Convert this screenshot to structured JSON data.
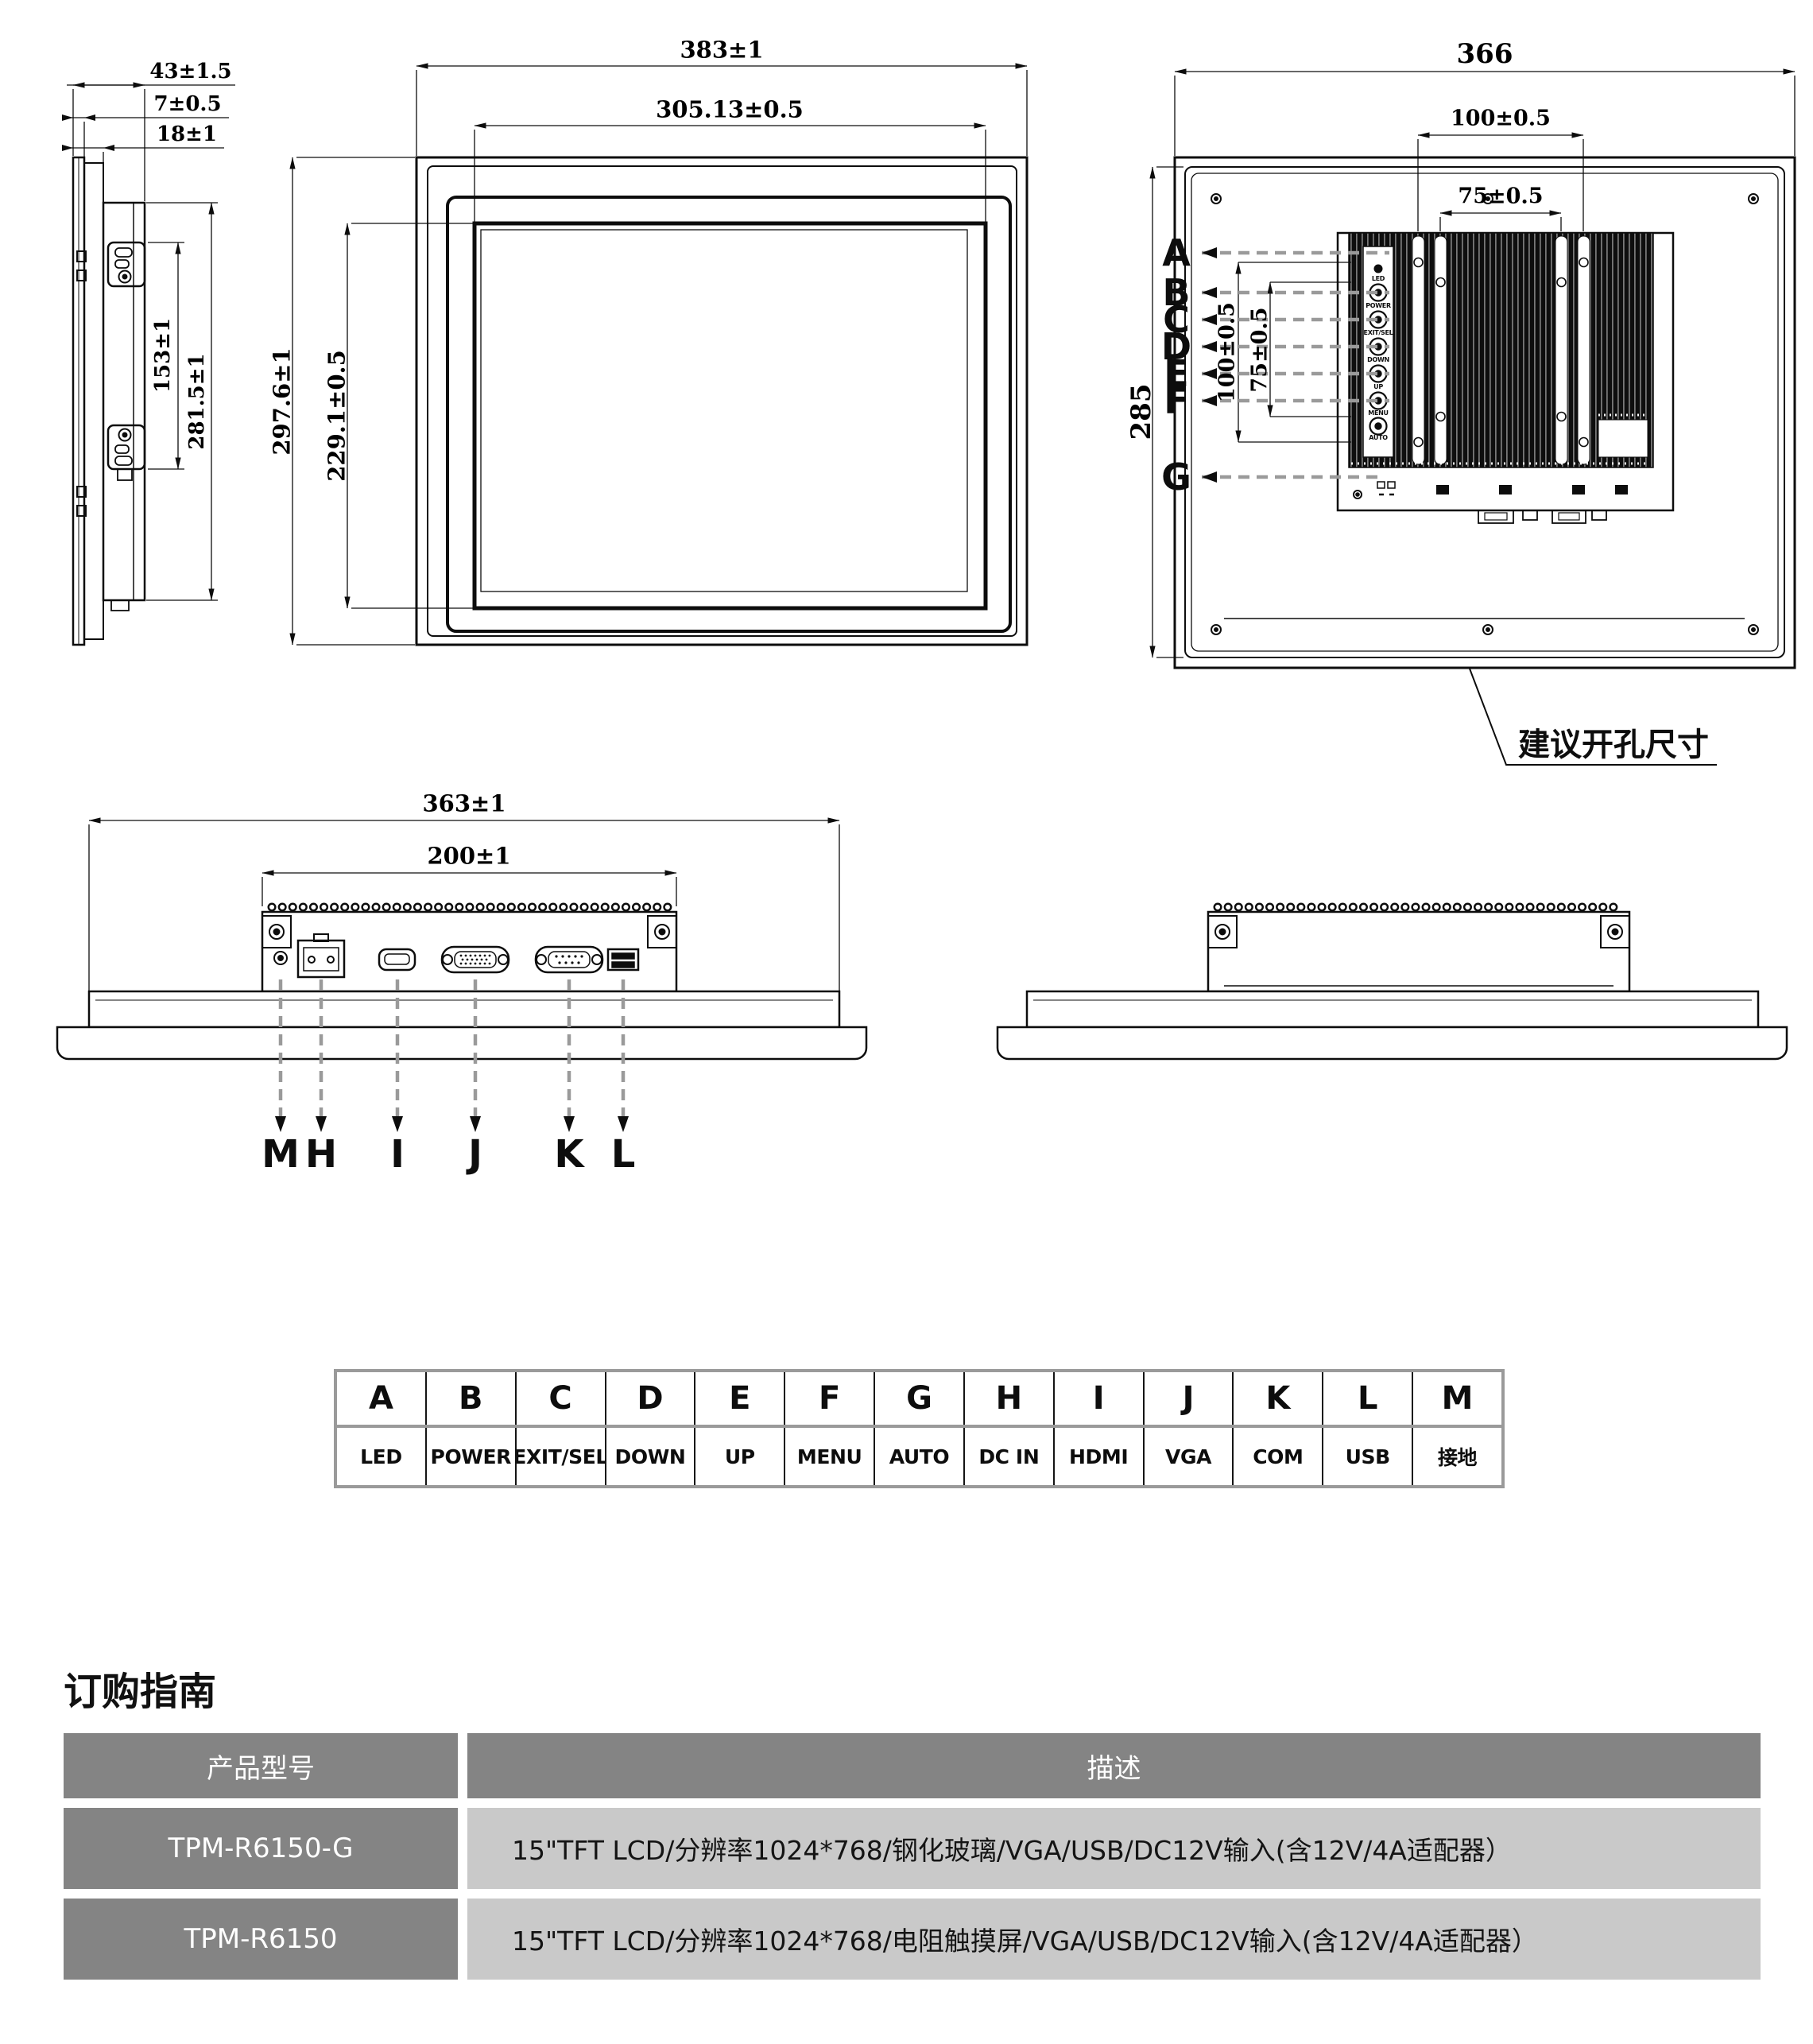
{
  "side_view": {
    "dim_depth_total": "43±1.5",
    "dim_glass_depth": "7±0.5",
    "dim_bezel_depth": "18±1",
    "dim_bracket_span": "153±1",
    "dim_height": "281.5±1"
  },
  "front_view": {
    "dim_width": "383±1",
    "dim_active_width": "305.13±0.5",
    "dim_height": "297.6±1",
    "dim_active_height": "229.1±0.5"
  },
  "rear_view": {
    "dim_width": "366",
    "dim_height": "285",
    "dim_vesa_w100": "100±0.5",
    "dim_vesa_w75": "75±0.5",
    "dim_vesa_h100": "100±0.5",
    "dim_vesa_h75": "75±0.5",
    "callout_cutout": "建议开孔尺寸",
    "labels": [
      "A",
      "B",
      "C",
      "D",
      "E",
      "F",
      "G"
    ],
    "osd": [
      "LED",
      "POWER",
      "EXIT/SEL",
      "DOWN",
      "UP",
      "MENU",
      "AUTO"
    ]
  },
  "bottom_view": {
    "dim_width": "363±1",
    "dim_module_width": "200±1",
    "labels": [
      "M",
      "H",
      "I",
      "J",
      "K",
      "L"
    ]
  },
  "legend_table": {
    "headers": [
      "A",
      "B",
      "C",
      "D",
      "E",
      "F",
      "G",
      "H",
      "I",
      "J",
      "K",
      "L",
      "M"
    ],
    "values": [
      "LED",
      "POWER",
      "EXIT/SEL",
      "DOWN",
      "UP",
      "MENU",
      "AUTO",
      "DC IN",
      "HDMI",
      "VGA",
      "COM",
      "USB",
      "接地"
    ]
  },
  "ordering": {
    "title": "订购指南",
    "col_model": "产品型号",
    "col_desc": "描述",
    "rows": [
      {
        "model": "TPM-R6150-G",
        "desc": "15\"TFT LCD/分辨率1024*768/钢化玻璃/VGA/USB/DC12V输入(含12V/4A适配器）"
      },
      {
        "model": "TPM-R6150",
        "desc": "15\"TFT LCD/分辨率1024*768/电阻触摸屏/VGA/USB/DC12V输入(含12V/4A适配器）"
      }
    ]
  },
  "colors": {
    "table_header": "#848484",
    "table_model_cell": "#848484",
    "table_desc_cell": "#c9c9c9",
    "leader_gray": "#9a9a9a",
    "line": "#0d0d0d"
  }
}
